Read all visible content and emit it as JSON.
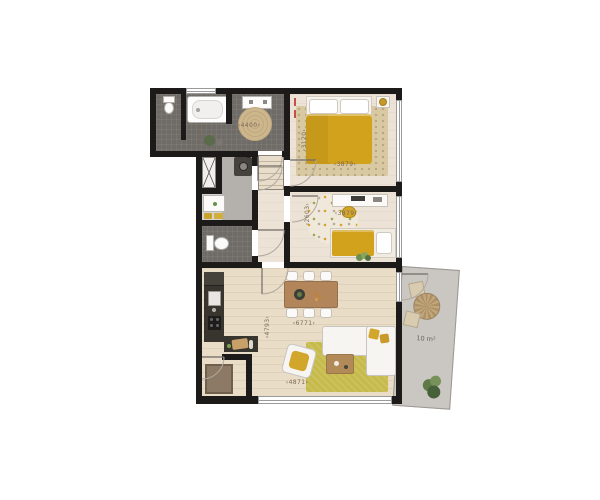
{
  "dimensions": {
    "bathroom": {
      "width": "4400",
      "depth": "1970"
    },
    "bedroom_top": {
      "width": "3879",
      "depth": "3120"
    },
    "bedroom_middle": {
      "width": "3879",
      "depth": "2603"
    },
    "living_room": {
      "width": "6771",
      "depth": "4793",
      "entry": "4871"
    },
    "balcony": {
      "area": "10 m²"
    }
  },
  "colors": {
    "wall": "#1d1b19",
    "accent_yellow": "#d2a21c",
    "floor_wood": "#e9ddc7",
    "tile_dark": "#6f6b67",
    "rug_green": "#c6ba4a",
    "balcony_floor": "#cac6c1",
    "dimension_text": "#7d6a58"
  }
}
